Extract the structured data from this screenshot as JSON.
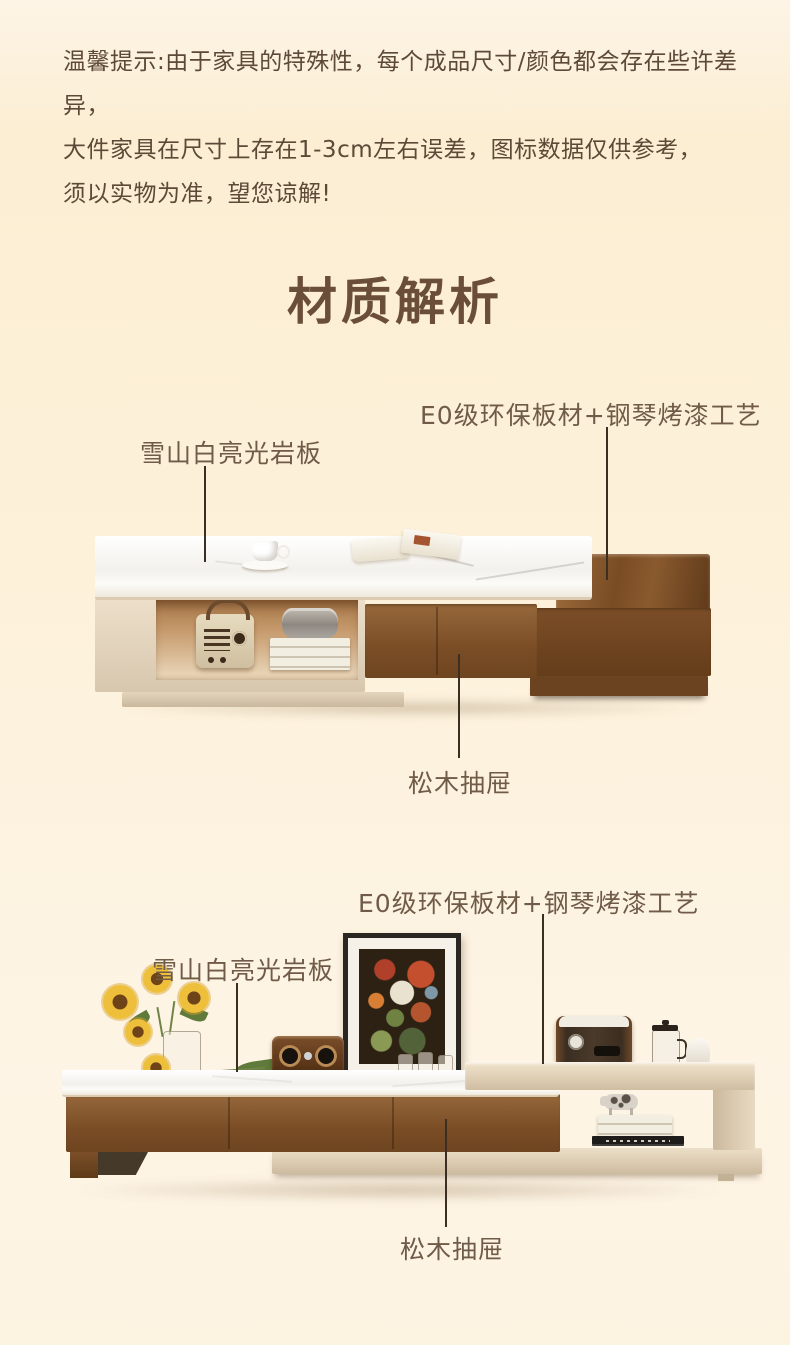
{
  "title": "材质解析",
  "disclaimer": {
    "line1": "温馨提示:由于家具的特殊性，每个成品尺寸/颜色都会存在些许差异，",
    "line2": "大件家具在尺寸上存在1-3cm左右误差，图标数据仅供参考，",
    "line3": "须以实物为准，望您谅解!"
  },
  "sections": [
    {
      "id": "coffee-table",
      "labels": {
        "eco_board": "E0级环保板材+钢琴烤漆工艺",
        "slate_top": "雪山白亮光岩板",
        "pine_drawer": "松木抽屉"
      }
    },
    {
      "id": "tv-stand",
      "labels": {
        "eco_board": "E0级环保板材+钢琴烤漆工艺",
        "slate_top": "雪山白亮光岩板",
        "pine_drawer": "松木抽屉"
      }
    }
  ],
  "colors": {
    "page_bg": "#fdf2dc",
    "ink": "#5d4937",
    "title_ink": "#6a4e3a",
    "label_ink": "#6f5b47",
    "line_ink": "#3b2f23",
    "wood": "#7b4e26",
    "cream": "#e0d0ba",
    "marble": "#f6f4ef"
  }
}
